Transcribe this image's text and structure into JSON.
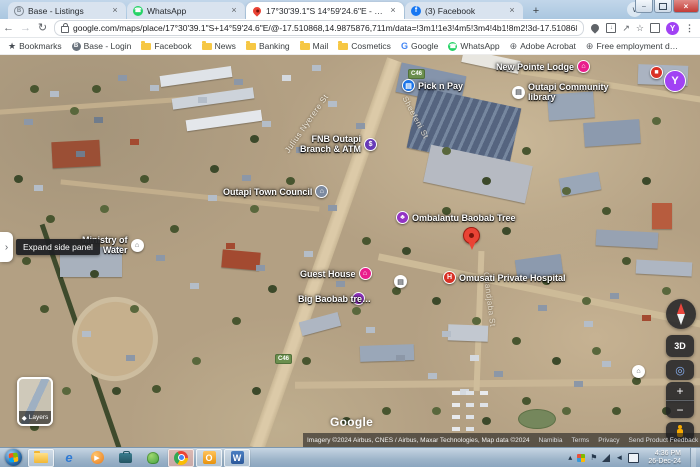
{
  "browser": {
    "tabs": [
      {
        "label": "Base - Listings"
      },
      {
        "label": "WhatsApp"
      },
      {
        "label": "17°30'39.1\"S 14°59'24.6\"E - Go…"
      },
      {
        "label": "(3) Facebook"
      }
    ],
    "new_tab_label": "+",
    "url": "google.com/maps/place/17°30'39.1\"S+14°59'24.6\"E/@-17.510868,14.9875876,711m/data=!3m1!1e3!4m5!3m4!4b1!8m2!3d-17.510868!4d14.9901625?hl=en&…",
    "avatar_initial": "Y",
    "glyphs": {
      "facebook": "f",
      "whatsapp": "☎",
      "google": "G",
      "base": "B",
      "ie": "e",
      "outlook": "O",
      "word": "W",
      "menu": "⋮",
      "back": "←",
      "forward": "→",
      "reload": "↻",
      "star": "☆",
      "down_arrow": "↓",
      "share": "↗",
      "chevron": "∨",
      "close": "×",
      "minimize": "–"
    },
    "bookmarks": {
      "bookmarks_label": "Bookmarks",
      "items": [
        "Base - Login",
        "Facebook",
        "News",
        "Banking",
        "Mail",
        "Cosmetics",
        "Google",
        "WhatsApp",
        "Adobe Acrobat",
        "Free employment d…"
      ]
    }
  },
  "map": {
    "side_panel_tooltip": "Expand side panel",
    "layers_label": "Layers",
    "layers_icon": "◆",
    "watermark": "Google",
    "pois": {
      "pick_n_pay": "Pick n Pay",
      "lodge": "New Pointe Lodge",
      "library": "Outapi Community\nlibrary",
      "fnb": "FNB Outapi\nBranch & ATM",
      "fnb_glyph": "$",
      "town_council": "Outapi Town Council",
      "baobab_tree": "Ombalantu Baobab Tree",
      "hospital": "Omusati Private Hospital",
      "hospital_glyph": "H",
      "ministry": "Ministry of\nWater",
      "guest_house": "Guest House",
      "big_baobab": "Big Baobab tre…",
      "y_marker": "Y"
    },
    "streets": {
      "julius": "Julius Nyerere St",
      "main": "Sheefeni St",
      "hospital_rd": "Onandjaba St"
    },
    "road_badge": "C46",
    "controls": {
      "three_d": "3D",
      "zoom_in": "+",
      "zoom_out": "−"
    },
    "attribution": {
      "imagery": "Imagery ©2024 Airbus, CNES / Airbus, Maxar Technologies, Map data ©2024",
      "region": "Namibia",
      "terms": "Terms",
      "privacy": "Privacy",
      "feedback": "Send Product Feedback",
      "scale": "100 m"
    }
  },
  "taskbar": {
    "time": "4:36 PM",
    "date": "26-Dec-24"
  }
}
